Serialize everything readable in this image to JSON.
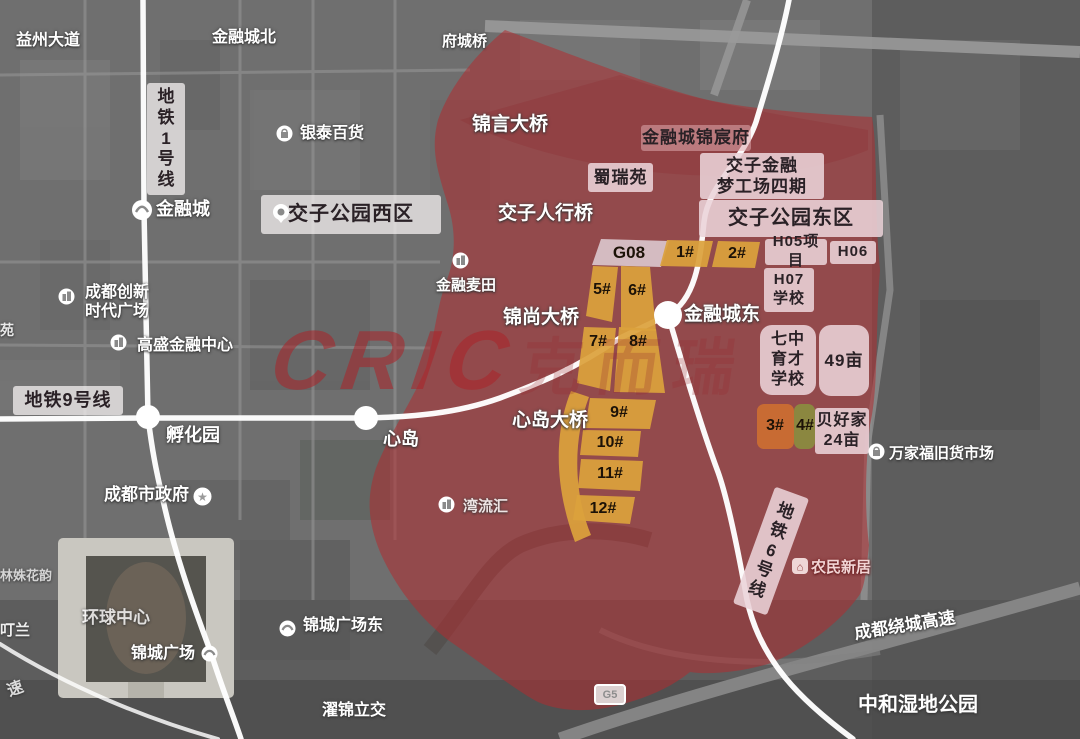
{
  "watermark": {
    "latin": "CRIC",
    "cjk": "克而瑞"
  },
  "highway_shield": {
    "text": "G5",
    "x": 594,
    "y": 684,
    "w": 28,
    "h": 17
  },
  "map_labels": [
    {
      "id": "yizhou-avenue-label",
      "text": "益州大道",
      "x": 16,
      "y": 32,
      "size": 16
    },
    {
      "id": "financial-city-north-label",
      "text": "金融城北",
      "x": 212,
      "y": 29,
      "size": 16
    },
    {
      "id": "fucheng-bridge-label",
      "text": "府城桥",
      "x": 442,
      "y": 33,
      "size": 15
    },
    {
      "id": "yintai-department-store-label",
      "text": "银泰百货",
      "x": 300,
      "y": 125,
      "size": 16,
      "icon": {
        "type": "bag",
        "x": 276,
        "y": 125
      }
    },
    {
      "id": "financial-city-station-label",
      "text": "金融城",
      "x": 156,
      "y": 199,
      "size": 18
    },
    {
      "id": "chengdu-innovation-times-plaza-label",
      "lines": [
        "成都创新",
        "时代广场"
      ],
      "x": 85,
      "y": 284,
      "size": 16,
      "icon": {
        "type": "building",
        "x": 58,
        "y": 288
      }
    },
    {
      "id": "goldman-financial-center-label",
      "text": "高盛金融中心",
      "x": 137,
      "y": 337,
      "size": 16,
      "icon": {
        "type": "building",
        "x": 110,
        "y": 334
      }
    },
    {
      "id": "financial-wheat-field-label",
      "text": "金融麦田",
      "x": 436,
      "y": 277,
      "size": 15,
      "icon": {
        "type": "building",
        "x": 452,
        "y": 252
      }
    },
    {
      "id": "chengdu-municipal-government-label",
      "text": "成都市政府",
      "x": 104,
      "y": 485,
      "size": 17,
      "icon": {
        "type": "star",
        "x": 193,
        "y": 487
      }
    },
    {
      "id": "global-center-label",
      "text": "环球中心",
      "x": 82,
      "y": 608,
      "size": 17,
      "opacity": 0.8
    },
    {
      "id": "jincheng-square-station-label",
      "text": "锦城广场",
      "x": 131,
      "y": 645,
      "size": 16,
      "icon": {
        "type": "metro",
        "x": 201,
        "y": 645
      }
    },
    {
      "id": "jincheng-square-east-station-label",
      "text": "锦城广场东",
      "x": 303,
      "y": 617,
      "size": 16,
      "icon": {
        "type": "metro",
        "x": 279,
        "y": 620
      }
    },
    {
      "id": "zhuojin-interchange-label",
      "text": "濯锦立交",
      "x": 322,
      "y": 702,
      "size": 16
    },
    {
      "id": "wanliuhui-label",
      "text": "湾流汇",
      "x": 463,
      "y": 498,
      "size": 15,
      "opacity": 0.85,
      "icon": {
        "type": "building",
        "x": 438,
        "y": 496
      }
    },
    {
      "id": "wanjiafu-secondhand-market-label",
      "text": "万家福旧货市场",
      "x": 889,
      "y": 445,
      "size": 15,
      "icon": {
        "type": "bag",
        "x": 868,
        "y": 443
      }
    },
    {
      "id": "chengdu-ring-expressway-label",
      "text": "成都绕城高速",
      "x": 853,
      "y": 624,
      "size": 17,
      "rotate": -9
    },
    {
      "id": "zhonghe-wetland-park-label",
      "text": "中和湿地公园",
      "x": 858,
      "y": 694,
      "size": 20
    },
    {
      "id": "fuhuayuan-station-label",
      "text": "孵化园",
      "x": 166,
      "y": 425,
      "size": 18
    },
    {
      "id": "xindao-station-label",
      "text": "心岛",
      "x": 383,
      "y": 429,
      "size": 18
    },
    {
      "id": "financial-city-east-station-label",
      "text": "金融城东",
      "x": 684,
      "y": 304,
      "size": 19
    },
    {
      "id": "farmers-new-homes-label",
      "text": "农民新居",
      "x": 811,
      "y": 559,
      "size": 15,
      "style": "pinkred",
      "icon": {
        "type": "house",
        "x": 792,
        "y": 558
      }
    },
    {
      "id": "edge-label-yuan",
      "text": "苑",
      "x": 0,
      "y": 322,
      "size": 14,
      "opacity": 0.85
    },
    {
      "id": "edge-label-flower-garden",
      "text": "林姝花韵",
      "x": 0,
      "y": 568,
      "size": 13,
      "opacity": 0.7
    },
    {
      "id": "edge-label-lan",
      "text": "叮兰",
      "x": 0,
      "y": 622,
      "size": 15,
      "opacity": 0.9
    },
    {
      "id": "edge-label-expressway-partial",
      "text": "速",
      "x": 5,
      "y": 684,
      "size": 16,
      "rotate": -20,
      "opacity": 0.8
    },
    {
      "id": "jinyan-bridge-label",
      "text": "锦言大桥",
      "x": 472,
      "y": 114,
      "size": 19
    },
    {
      "id": "jiaozi-footbridge-label",
      "text": "交子人行桥",
      "x": 498,
      "y": 203,
      "size": 19
    },
    {
      "id": "jinshang-bridge-label",
      "text": "锦尚大桥",
      "x": 503,
      "y": 307,
      "size": 19
    },
    {
      "id": "xindao-bridge-label",
      "text": "心岛大桥",
      "x": 512,
      "y": 410,
      "size": 19
    }
  ],
  "zone_boxes": [
    {
      "id": "metro-line-1-label",
      "text": "地铁1号线",
      "x": 147,
      "y": 83,
      "w": 38,
      "h": 112,
      "size": 17,
      "bg": "white",
      "vertical": true
    },
    {
      "id": "metro-line-9-label",
      "text": "地铁9号线",
      "x": 13,
      "y": 386,
      "w": 110,
      "h": 29,
      "size": 18,
      "bg": "white"
    },
    {
      "id": "metro-line-6-label",
      "text": "地铁6号线",
      "x": 753,
      "y": 489,
      "w": 36,
      "h": 124,
      "size": 17,
      "bg": "pink",
      "vertical": true,
      "rotate": 20
    },
    {
      "id": "jiaozi-park-west-box",
      "text": "交子公园西区",
      "x": 261,
      "y": 195,
      "w": 180,
      "h": 39,
      "size": 20,
      "bg": "white",
      "icon": {
        "type": "pin",
        "x": 272,
        "y": 204
      }
    },
    {
      "id": "shuruiyuan-box",
      "text": "蜀瑞苑",
      "x": 588,
      "y": 163,
      "w": 65,
      "h": 29,
      "size": 17,
      "bg": "pink"
    },
    {
      "id": "financial-city-jinchenfu-box",
      "text": "金融城锦宸府",
      "x": 641,
      "y": 125,
      "w": 110,
      "h": 26,
      "size": 17,
      "bg": "redlight"
    },
    {
      "id": "jiaozi-dream-works-phase4-box",
      "lines": [
        "交子金融",
        "梦工场四期"
      ],
      "x": 700,
      "y": 153,
      "w": 124,
      "h": 46,
      "size": 17,
      "bg": "pink"
    },
    {
      "id": "jiaozi-park-east-box",
      "text": "交子公园东区",
      "x": 699,
      "y": 200,
      "w": 184,
      "h": 37,
      "size": 20,
      "bg": "pink"
    },
    {
      "id": "h05-project-box",
      "text": "H05项目",
      "x": 765,
      "y": 239,
      "w": 62,
      "h": 26,
      "size": 15,
      "bg": "pink"
    },
    {
      "id": "h06-box",
      "text": "H06",
      "x": 830,
      "y": 241,
      "w": 46,
      "h": 23,
      "size": 15,
      "bg": "pink"
    },
    {
      "id": "h07-school-box",
      "lines": [
        "H07",
        "学校"
      ],
      "x": 764,
      "y": 268,
      "w": 50,
      "h": 44,
      "size": 15,
      "bg": "pink"
    },
    {
      "id": "qizhong-yucai-school-box",
      "lines": [
        "七中",
        "育才",
        "学校"
      ],
      "x": 760,
      "y": 325,
      "w": 56,
      "h": 70,
      "size": 16,
      "bg": "pink",
      "radius": 12
    },
    {
      "id": "mu49-box",
      "text": "49亩",
      "x": 819,
      "y": 325,
      "w": 50,
      "h": 71,
      "size": 17,
      "bg": "pink",
      "radius": 12
    },
    {
      "id": "beihaojia-24mu-box",
      "lines": [
        "贝好家",
        "24亩"
      ],
      "x": 815,
      "y": 408,
      "w": 54,
      "h": 46,
      "size": 16,
      "bg": "pink"
    }
  ],
  "parcels": [
    {
      "id": "parcel-g08",
      "label": "G08",
      "fill": "#d9c4ca",
      "points": [
        [
          601,
          239
        ],
        [
          669,
          241
        ],
        [
          661,
          267
        ],
        [
          592,
          265
        ]
      ],
      "lx": 629,
      "ly": 253,
      "size": 17
    },
    {
      "id": "parcel-1",
      "label": "1#",
      "fill": "#dca13c",
      "points": [
        [
          667,
          240
        ],
        [
          713,
          241
        ],
        [
          707,
          267
        ],
        [
          660,
          266
        ]
      ],
      "lx": 685,
      "ly": 253
    },
    {
      "id": "parcel-2",
      "label": "2#",
      "fill": "#dca13c",
      "points": [
        [
          718,
          241
        ],
        [
          760,
          242
        ],
        [
          755,
          268
        ],
        [
          712,
          267
        ]
      ],
      "lx": 737,
      "ly": 254
    },
    {
      "id": "parcel-5",
      "label": "5#",
      "fill": "#dca13c",
      "points": [
        [
          593,
          266
        ],
        [
          618,
          267
        ],
        [
          612,
          322
        ],
        [
          586,
          316
        ]
      ],
      "lx": 602,
      "ly": 290
    },
    {
      "id": "parcel-6",
      "label": "6#",
      "fill": "#dca13c",
      "points": [
        [
          621,
          266
        ],
        [
          650,
          267
        ],
        [
          656,
          331
        ],
        [
          621,
          330
        ]
      ],
      "lx": 637,
      "ly": 291
    },
    {
      "id": "parcel-7",
      "label": "7#",
      "fill": "#dca13c",
      "points": [
        [
          584,
          327
        ],
        [
          616,
          328
        ],
        [
          610,
          391
        ],
        [
          577,
          383
        ]
      ],
      "lx": 598,
      "ly": 342
    },
    {
      "id": "parcel-8",
      "label": "8#",
      "fill": "#dca13c",
      "points": [
        [
          619,
          327
        ],
        [
          656,
          329
        ],
        [
          665,
          393
        ],
        [
          614,
          392
        ]
      ],
      "lx": 638,
      "ly": 342
    },
    {
      "id": "parcel-9",
      "label": "9#",
      "fill": "#dca13c",
      "points": [
        [
          590,
          398
        ],
        [
          656,
          400
        ],
        [
          650,
          429
        ],
        [
          585,
          428
        ]
      ],
      "lx": 619,
      "ly": 413
    },
    {
      "id": "parcel-10",
      "label": "10#",
      "fill": "#dca13c",
      "points": [
        [
          583,
          430
        ],
        [
          641,
          431
        ],
        [
          638,
          457
        ],
        [
          580,
          455
        ]
      ],
      "lx": 610,
      "ly": 443
    },
    {
      "id": "parcel-11",
      "label": "11#",
      "fill": "#dca13c",
      "points": [
        [
          581,
          459
        ],
        [
          643,
          461
        ],
        [
          640,
          491
        ],
        [
          578,
          488
        ]
      ],
      "lx": 610,
      "ly": 474
    },
    {
      "id": "parcel-12",
      "label": "12#",
      "fill": "#dca13c",
      "points": [
        [
          577,
          495
        ],
        [
          635,
          497
        ],
        [
          630,
          524
        ],
        [
          573,
          520
        ]
      ],
      "lx": 603,
      "ly": 509
    },
    {
      "id": "parcel-strip",
      "label": "",
      "fill": "#dca13c",
      "path": "M571,391 C555,430 553,483 575,542 L591,535 C572,489 574,436 589,397 Z"
    },
    {
      "id": "parcel-3",
      "label": "3#",
      "fill": "#cc6e31",
      "rect": [
        757,
        404,
        37,
        45
      ],
      "radius": 7,
      "lx": 775,
      "ly": 426
    },
    {
      "id": "parcel-4",
      "label": "4#",
      "fill": "#8b8c3f",
      "rect": [
        794,
        404,
        21,
        45
      ],
      "radius": 7,
      "lx": 805,
      "ly": 426
    }
  ],
  "stations": [
    {
      "id": "financial-city-station-dot",
      "type": "metro",
      "cx": 142,
      "cy": 210,
      "r": 10
    },
    {
      "id": "fuhuayuan-station-dot",
      "type": "dot",
      "cx": 148,
      "cy": 417,
      "r": 12
    },
    {
      "id": "xindao-station-dot",
      "type": "dot",
      "cx": 366,
      "cy": 418,
      "r": 12
    },
    {
      "id": "financial-city-east-station-dot",
      "type": "dot",
      "cx": 668,
      "cy": 315,
      "r": 14
    }
  ]
}
